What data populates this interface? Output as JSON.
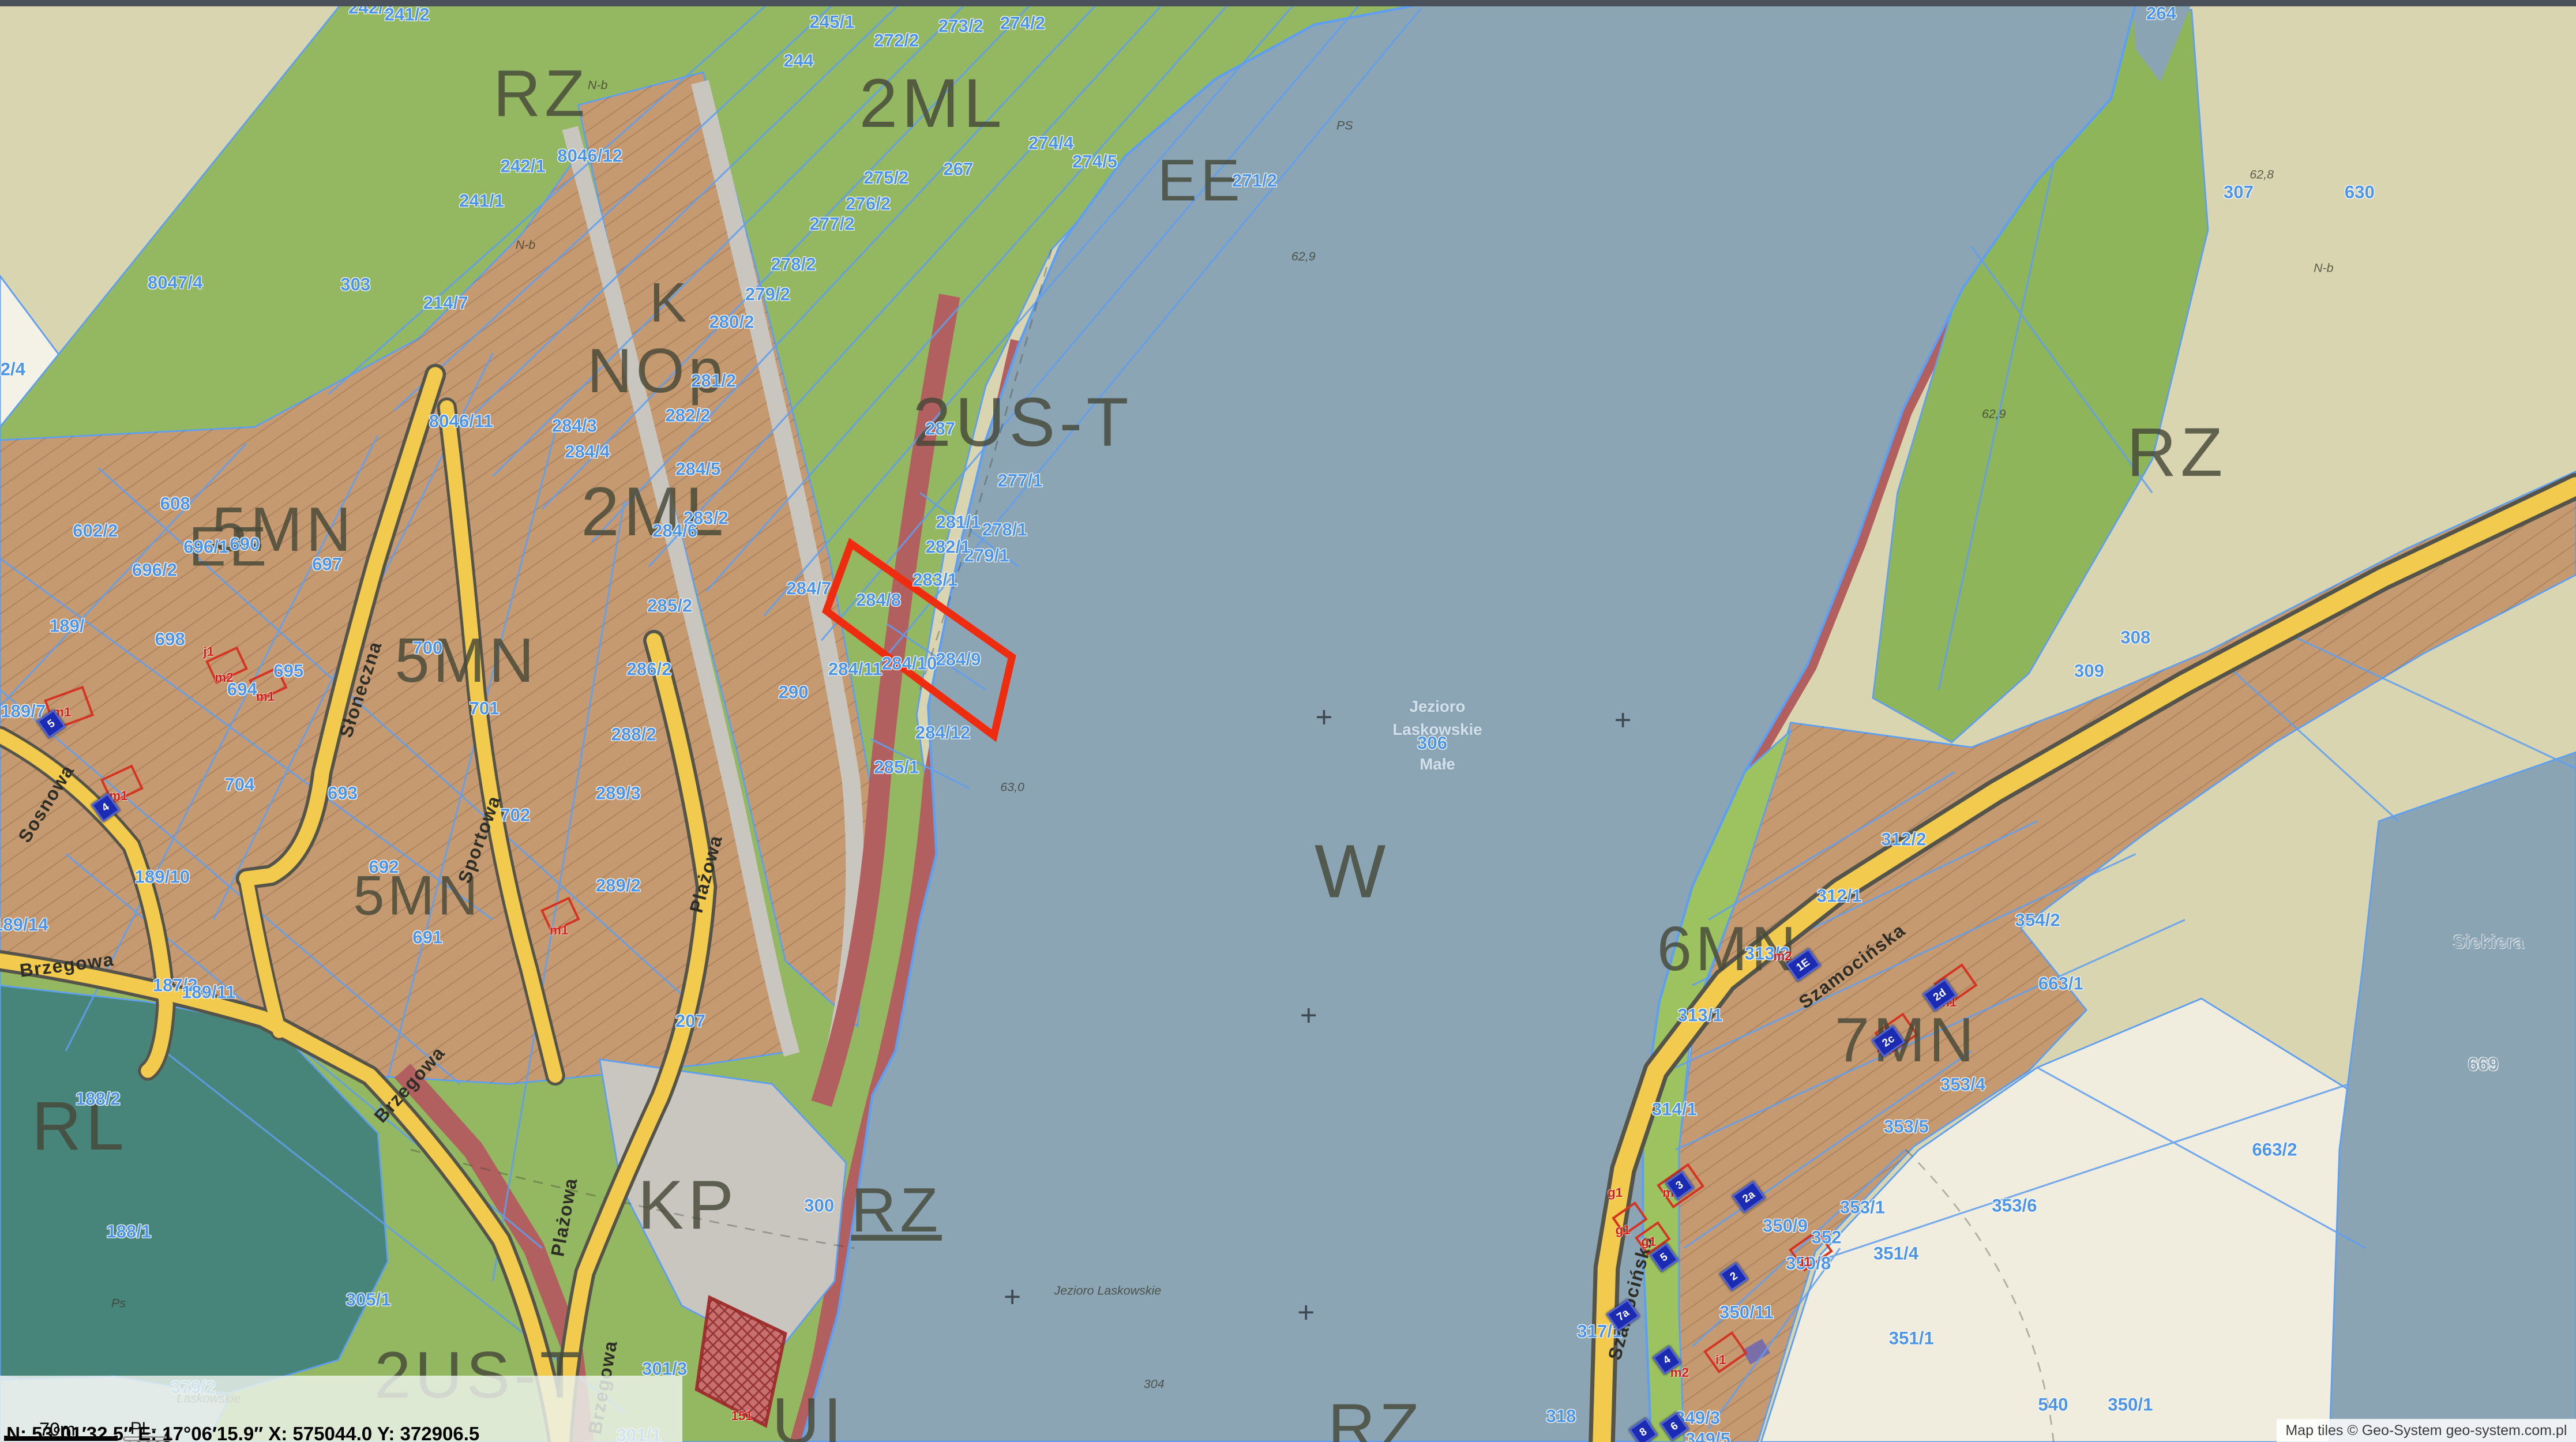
{
  "chrome": {
    "scale_bar_label": "70m",
    "crs_selected": "PL-1992",
    "status_bar": "N: 53°01′32.5″  E: 17°06′15.9″   X: 575044.0   Y: 372906.5",
    "attribution": "Map tiles © Geo-System geo-system.com.pl"
  },
  "colors": {
    "water": "#8ca5b4",
    "khaki_field": "#d9d5b1",
    "cream_field": "#f0edde",
    "grass_green": "#94b761",
    "shore_green": "#9dc361",
    "residential_tan": "#c59a71",
    "beach_red": "#b2605f",
    "forest_teal": "#47857a",
    "road_yellow": "#f2ca4e",
    "road_gray": "#c9c6bf",
    "parcel_line_blue": "#5f9ff0",
    "parcel_label_blue": "#4f95e6",
    "selection_red": "#ee2d10",
    "building_plaque_blue": "#1c2cb2",
    "building_mark_red": "#d02018"
  },
  "map": {
    "zone_labels": [
      {
        "t": "RZ",
        "x": 21.0,
        "y": 6.5,
        "s": 40
      },
      {
        "t": "2ML",
        "x": 36.2,
        "y": 7.2,
        "s": 42
      },
      {
        "t": "EE",
        "x": 46.6,
        "y": 12.5,
        "s": 36
      },
      {
        "t": "K",
        "x": 26.0,
        "y": 21.0,
        "s": 34
      },
      {
        "t": "NOp",
        "x": 25.5,
        "y": 25.7,
        "s": 38
      },
      {
        "t": "2US-T",
        "x": 39.7,
        "y": 29.3,
        "s": 42
      },
      {
        "t": "2ML",
        "x": 25.4,
        "y": 35.5,
        "s": 42
      },
      {
        "t": "5MN",
        "x": 11.0,
        "y": 36.7,
        "s": 38
      },
      {
        "t": "EE",
        "x": 8.9,
        "y": 37.9,
        "s": 34
      },
      {
        "t": "5MN",
        "x": 18.1,
        "y": 45.8,
        "s": 38
      },
      {
        "t": "5MN",
        "x": 16.2,
        "y": 62.1,
        "s": 34
      },
      {
        "t": "RZ",
        "x": 84.5,
        "y": 31.4,
        "s": 42
      },
      {
        "t": "W",
        "x": 52.5,
        "y": 60.4,
        "s": 46
      },
      {
        "t": "KP",
        "x": 26.7,
        "y": 83.6,
        "s": 42
      },
      {
        "t": "RZ",
        "x": 34.8,
        "y": 83.9,
        "s": 38,
        "u": 1
      },
      {
        "t": "RL",
        "x": 3.1,
        "y": 78.1,
        "s": 42
      },
      {
        "t": "6MN",
        "x": 67.1,
        "y": 65.8,
        "s": 38
      },
      {
        "t": "7MN",
        "x": 74.0,
        "y": 72.1,
        "s": 38
      },
      {
        "t": "UI",
        "x": 31.4,
        "y": 98.6,
        "s": 40
      },
      {
        "t": "RZ",
        "x": 53.4,
        "y": 99.0,
        "s": 40
      },
      {
        "t": "2US-T",
        "x": 18.6,
        "y": 95.4,
        "s": 40
      }
    ],
    "parcel_labels": [
      {
        "t": "242/2",
        "x": 14.4,
        "y": 0.5
      },
      {
        "t": "241/2",
        "x": 15.8,
        "y": 1.0
      },
      {
        "t": "245/1",
        "x": 32.3,
        "y": 1.5
      },
      {
        "t": "244",
        "x": 31.0,
        "y": 4.2
      },
      {
        "t": "267",
        "x": 37.2,
        "y": 11.7
      },
      {
        "t": "242/1",
        "x": 20.3,
        "y": 11.5
      },
      {
        "t": "241/1",
        "x": 18.7,
        "y": 13.9
      },
      {
        "t": "8046/12",
        "x": 22.9,
        "y": 10.8
      },
      {
        "t": "214/7",
        "x": 17.3,
        "y": 21.0
      },
      {
        "t": "303",
        "x": 13.8,
        "y": 19.7
      },
      {
        "t": "8047/4",
        "x": 6.8,
        "y": 19.6
      },
      {
        "t": "8046/11",
        "x": 17.9,
        "y": 29.2
      },
      {
        "t": "2/4",
        "x": 0.5,
        "y": 25.6
      },
      {
        "t": "272/2",
        "x": 34.8,
        "y": 2.8
      },
      {
        "t": "273/2",
        "x": 37.3,
        "y": 1.8
      },
      {
        "t": "274/2",
        "x": 39.7,
        "y": 1.6
      },
      {
        "t": "274/4",
        "x": 40.8,
        "y": 9.9
      },
      {
        "t": "274/5",
        "x": 42.5,
        "y": 11.2
      },
      {
        "t": "271/2",
        "x": 48.7,
        "y": 12.5
      },
      {
        "t": "275/2",
        "x": 34.4,
        "y": 12.3
      },
      {
        "t": "276/2",
        "x": 33.7,
        "y": 14.1
      },
      {
        "t": "277/2",
        "x": 32.3,
        "y": 15.5
      },
      {
        "t": "278/2",
        "x": 30.8,
        "y": 18.3
      },
      {
        "t": "279/2",
        "x": 29.8,
        "y": 20.4
      },
      {
        "t": "280/2",
        "x": 28.4,
        "y": 22.3
      },
      {
        "t": "281/2",
        "x": 27.7,
        "y": 26.4
      },
      {
        "t": "282/2",
        "x": 26.7,
        "y": 28.8
      },
      {
        "t": "283/2",
        "x": 27.4,
        "y": 35.9
      },
      {
        "t": "287",
        "x": 36.5,
        "y": 29.7
      },
      {
        "t": "277/1",
        "x": 39.6,
        "y": 33.3
      },
      {
        "t": "278/1",
        "x": 39.0,
        "y": 36.7
      },
      {
        "t": "279/1",
        "x": 38.3,
        "y": 38.5
      },
      {
        "t": "284/3",
        "x": 22.3,
        "y": 29.5
      },
      {
        "t": "284/4",
        "x": 22.8,
        "y": 31.3
      },
      {
        "t": "284/5",
        "x": 27.1,
        "y": 32.5
      },
      {
        "t": "284/6",
        "x": 26.2,
        "y": 36.8
      },
      {
        "t": "285/2",
        "x": 26.0,
        "y": 42.0
      },
      {
        "t": "286/2",
        "x": 25.2,
        "y": 46.4
      },
      {
        "t": "288/2",
        "x": 24.6,
        "y": 50.9
      },
      {
        "t": "289/3",
        "x": 24.0,
        "y": 55.0
      },
      {
        "t": "289/2",
        "x": 24.0,
        "y": 61.4
      },
      {
        "t": "290",
        "x": 30.8,
        "y": 48.0
      },
      {
        "t": "284/7",
        "x": 31.4,
        "y": 40.8
      },
      {
        "t": "284/8",
        "x": 34.1,
        "y": 41.6
      },
      {
        "t": "283/1",
        "x": 36.3,
        "y": 40.2
      },
      {
        "t": "282/1",
        "x": 36.8,
        "y": 37.9
      },
      {
        "t": "281/1",
        "x": 37.2,
        "y": 36.2
      },
      {
        "t": "284/9",
        "x": 37.2,
        "y": 45.7
      },
      {
        "t": "284/10",
        "x": 35.3,
        "y": 46.0
      },
      {
        "t": "284/11",
        "x": 33.2,
        "y": 46.4
      },
      {
        "t": "284/12",
        "x": 36.6,
        "y": 50.8
      },
      {
        "t": "285/1",
        "x": 34.8,
        "y": 53.2
      },
      {
        "t": "300",
        "x": 31.8,
        "y": 83.6
      },
      {
        "t": "301/3",
        "x": 25.8,
        "y": 94.9
      },
      {
        "t": "301/1",
        "x": 24.8,
        "y": 99.5
      },
      {
        "t": "305/1",
        "x": 14.3,
        "y": 90.1
      },
      {
        "t": "187/2",
        "x": 6.8,
        "y": 68.3
      },
      {
        "t": "188/2",
        "x": 3.8,
        "y": 76.2
      },
      {
        "t": "188/1",
        "x": 5.0,
        "y": 85.4
      },
      {
        "t": "189/",
        "x": 2.6,
        "y": 43.4
      },
      {
        "t": "189/7",
        "x": 0.9,
        "y": 49.3
      },
      {
        "t": "189/10",
        "x": 6.3,
        "y": 60.8
      },
      {
        "t": "189/11",
        "x": 8.1,
        "y": 68.8
      },
      {
        "t": "189/14",
        "x": 0.8,
        "y": 64.1
      },
      {
        "t": "602/2",
        "x": 3.7,
        "y": 36.8
      },
      {
        "t": "608",
        "x": 6.8,
        "y": 34.9
      },
      {
        "t": "690",
        "x": 9.5,
        "y": 37.7
      },
      {
        "t": "698",
        "x": 6.6,
        "y": 44.3
      },
      {
        "t": "696/1",
        "x": 8.0,
        "y": 37.9
      },
      {
        "t": "696/2",
        "x": 6.0,
        "y": 39.5
      },
      {
        "t": "697",
        "x": 12.7,
        "y": 39.1
      },
      {
        "t": "695",
        "x": 11.2,
        "y": 46.5
      },
      {
        "t": "694",
        "x": 9.4,
        "y": 47.8
      },
      {
        "t": "700",
        "x": 16.6,
        "y": 44.9
      },
      {
        "t": "701",
        "x": 18.8,
        "y": 49.1
      },
      {
        "t": "702",
        "x": 20.0,
        "y": 56.5
      },
      {
        "t": "704",
        "x": 9.3,
        "y": 54.4
      },
      {
        "t": "691",
        "x": 16.6,
        "y": 65.0
      },
      {
        "t": "692",
        "x": 14.9,
        "y": 60.1
      },
      {
        "t": "693",
        "x": 13.3,
        "y": 55.0
      },
      {
        "t": "207",
        "x": 26.8,
        "y": 70.8
      },
      {
        "t": "306",
        "x": 55.6,
        "y": 51.5
      },
      {
        "t": "264",
        "x": 83.9,
        "y": 0.9
      },
      {
        "t": "630",
        "x": 91.6,
        "y": 13.3
      },
      {
        "t": "307",
        "x": 86.9,
        "y": 13.3
      },
      {
        "t": "308",
        "x": 82.9,
        "y": 44.2
      },
      {
        "t": "309",
        "x": 81.1,
        "y": 46.5
      },
      {
        "t": "312/1",
        "x": 71.4,
        "y": 62.1
      },
      {
        "t": "312/2",
        "x": 73.9,
        "y": 58.2
      },
      {
        "t": "313/2",
        "x": 68.6,
        "y": 66.1
      },
      {
        "t": "313/1",
        "x": 66.0,
        "y": 70.4
      },
      {
        "t": "314/1",
        "x": 65.0,
        "y": 76.9
      },
      {
        "t": "317/1",
        "x": 62.1,
        "y": 92.3
      },
      {
        "t": "318",
        "x": 60.6,
        "y": 98.2
      },
      {
        "t": "354/2",
        "x": 79.1,
        "y": 63.8
      },
      {
        "t": "353/4",
        "x": 76.2,
        "y": 75.2
      },
      {
        "t": "353/5",
        "x": 74.0,
        "y": 78.1
      },
      {
        "t": "353/1",
        "x": 72.3,
        "y": 83.7
      },
      {
        "t": "352",
        "x": 70.9,
        "y": 85.8
      },
      {
        "t": "350/8",
        "x": 70.2,
        "y": 87.6
      },
      {
        "t": "350/9",
        "x": 69.3,
        "y": 85.0
      },
      {
        "t": "350/11",
        "x": 67.8,
        "y": 91.0
      },
      {
        "t": "349/3",
        "x": 65.9,
        "y": 98.3
      },
      {
        "t": "349/5",
        "x": 66.3,
        "y": 99.8
      },
      {
        "t": "350/1",
        "x": 82.7,
        "y": 97.4
      },
      {
        "t": "351/1",
        "x": 74.2,
        "y": 92.8
      },
      {
        "t": "351/4",
        "x": 73.6,
        "y": 86.9
      },
      {
        "t": "353/6",
        "x": 78.2,
        "y": 83.6
      },
      {
        "t": "540",
        "x": 79.7,
        "y": 97.4
      },
      {
        "t": "663/1",
        "x": 80.0,
        "y": 68.2
      },
      {
        "t": "663/2",
        "x": 88.3,
        "y": 79.7
      },
      {
        "t": "669",
        "x": 96.4,
        "y": 73.8
      },
      {
        "t": "379/2",
        "x": 7.5,
        "y": 96.2
      }
    ],
    "street_labels": [
      {
        "t": "Słoneczna",
        "x": 14.0,
        "y": 47.8,
        "r": -72
      },
      {
        "t": "Sosnowa",
        "x": 1.8,
        "y": 55.7,
        "r": -58
      },
      {
        "t": "Sportowa",
        "x": 18.6,
        "y": 58.2,
        "r": -70
      },
      {
        "t": "Brzegowa",
        "x": 2.6,
        "y": 66.9,
        "r": -7
      },
      {
        "t": "Brzegowa",
        "x": 15.9,
        "y": 75.2,
        "r": -48
      },
      {
        "t": "Plażowa",
        "x": 27.4,
        "y": 60.6,
        "r": -75
      },
      {
        "t": "Plażowa",
        "x": 21.9,
        "y": 84.4,
        "r": -80
      },
      {
        "t": "Brzegowa",
        "x": 23.4,
        "y": 96.2,
        "r": -80
      },
      {
        "t": "Szamocińska",
        "x": 71.9,
        "y": 67.0,
        "r": -37
      },
      {
        "t": "Szamocińska",
        "x": 63.3,
        "y": 90.0,
        "r": -75
      }
    ],
    "water_labels": [
      {
        "t": "Siekiera",
        "x": 96.6,
        "y": 65.3
      },
      {
        "t": "669",
        "x": 96.4,
        "y": 73.8
      }
    ],
    "lake_name_lines": [
      {
        "t": "Jezioro",
        "x": 55.8,
        "y": 49.0
      },
      {
        "t": "Laskowskie",
        "x": 55.8,
        "y": 50.6
      },
      {
        "t": "Małe",
        "x": 55.8,
        "y": 53.0
      }
    ],
    "elevation_labels": [
      {
        "t": "N-b",
        "x": 23.2,
        "y": 5.9
      },
      {
        "t": "N-b",
        "x": 20.4,
        "y": 17.0
      },
      {
        "t": "N-b",
        "x": 90.2,
        "y": 18.6
      },
      {
        "t": "62,9",
        "x": 50.6,
        "y": 17.8
      },
      {
        "t": "62,8",
        "x": 87.8,
        "y": 12.1
      },
      {
        "t": "62,9",
        "x": 77.4,
        "y": 28.7
      },
      {
        "t": "63,0",
        "x": 39.3,
        "y": 54.6
      },
      {
        "t": "PS",
        "x": 52.2,
        "y": 8.7
      },
      {
        "t": "Ps",
        "x": 4.6,
        "y": 90.4
      },
      {
        "t": "304",
        "x": 44.8,
        "y": 96.0
      },
      {
        "t": "Jezioro Laskowskie",
        "x": 43.0,
        "y": 89.5
      },
      {
        "t": "Laskowskie",
        "x": 8.1,
        "y": 97.0
      }
    ],
    "building_plaques": [
      {
        "t": "5",
        "x": 2.0,
        "y": 50.2
      },
      {
        "t": "4",
        "x": 4.1,
        "y": 56.0
      },
      {
        "t": "1E",
        "x": 70.0,
        "y": 66.9
      },
      {
        "t": "2d",
        "x": 75.3,
        "y": 69.0
      },
      {
        "t": "2c",
        "x": 73.3,
        "y": 72.2
      },
      {
        "t": "3",
        "x": 65.2,
        "y": 82.2
      },
      {
        "t": "5",
        "x": 64.6,
        "y": 87.2
      },
      {
        "t": "2a",
        "x": 67.9,
        "y": 83.0
      },
      {
        "t": "2",
        "x": 67.3,
        "y": 88.5
      },
      {
        "t": "7a",
        "x": 63.0,
        "y": 91.2
      },
      {
        "t": "4",
        "x": 64.7,
        "y": 94.3
      },
      {
        "t": "6",
        "x": 65.0,
        "y": 98.9
      },
      {
        "t": "8",
        "x": 63.8,
        "y": 99.3
      }
    ],
    "building_marks": [
      {
        "t": "m1",
        "x": 2.4,
        "y": 49.4
      },
      {
        "t": "m2",
        "x": 8.7,
        "y": 47.0
      },
      {
        "t": "j1",
        "x": 8.1,
        "y": 45.2
      },
      {
        "t": "m1",
        "x": 10.3,
        "y": 48.3
      },
      {
        "t": "m1",
        "x": 4.6,
        "y": 55.2
      },
      {
        "t": "m1",
        "x": 21.7,
        "y": 64.5
      },
      {
        "t": "m2",
        "x": 73.2,
        "y": 72.7
      },
      {
        "t": "m1",
        "x": 75.6,
        "y": 69.5
      },
      {
        "t": "m2",
        "x": 64.9,
        "y": 82.7
      },
      {
        "t": "g1",
        "x": 62.7,
        "y": 82.7
      },
      {
        "t": "g1",
        "x": 63.0,
        "y": 85.3
      },
      {
        "t": "g1",
        "x": 64.0,
        "y": 86.1
      },
      {
        "t": "i1",
        "x": 70.1,
        "y": 87.5
      },
      {
        "t": "i1",
        "x": 66.8,
        "y": 94.3
      },
      {
        "t": "m2",
        "x": 65.2,
        "y": 95.2
      },
      {
        "t": "m2",
        "x": 69.2,
        "y": 66.3
      },
      {
        "t": "151",
        "x": 28.8,
        "y": 98.2
      }
    ],
    "crosses": [
      {
        "x": 51.4,
        "y": 49.7
      },
      {
        "x": 63.0,
        "y": 49.9
      },
      {
        "x": 50.8,
        "y": 70.4
      },
      {
        "x": 50.7,
        "y": 91.0
      },
      {
        "x": 39.3,
        "y": 89.9
      }
    ]
  }
}
